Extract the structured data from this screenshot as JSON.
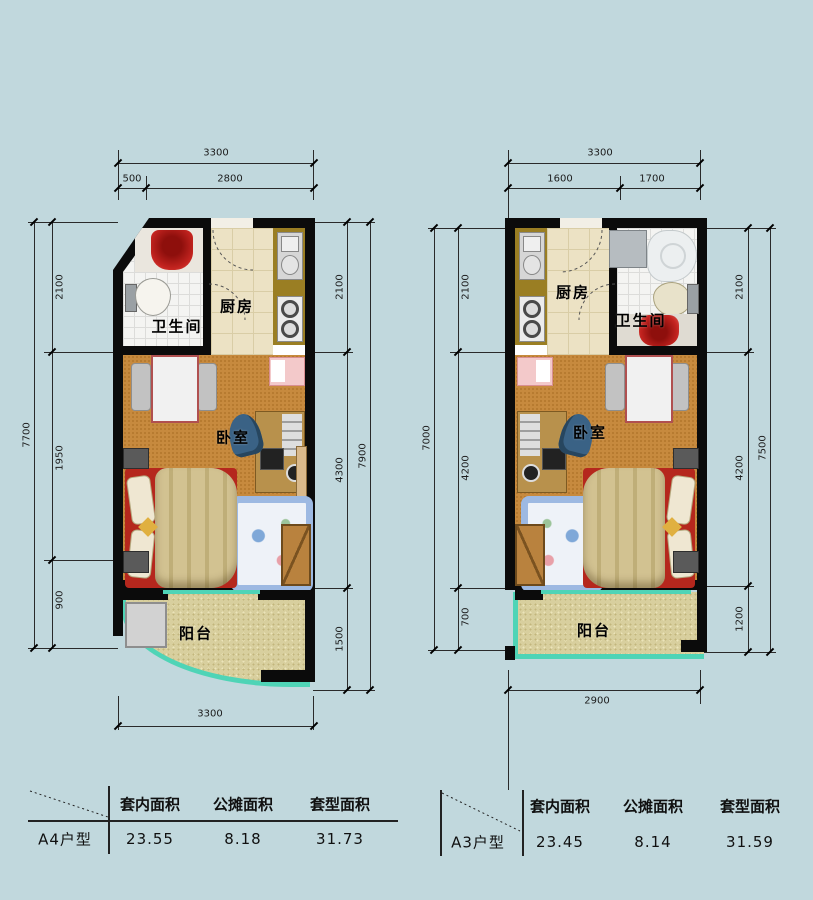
{
  "colors": {
    "background": "#c1d8dd",
    "wall": "#0b0b0b",
    "balcony_trim": "#4fd4b6",
    "bedroom_floor": "#c78a3e",
    "kitchen_counter": "#9a7e23",
    "bed_red": "#b5271d"
  },
  "plans": [
    {
      "name": "A4",
      "rooms": {
        "bathroom": "卫生间",
        "kitchen": "厨房",
        "bedroom": "卧室",
        "balcony": "阳台"
      },
      "dims": {
        "top_total": "3300",
        "top_seg1": "500",
        "top_seg2": "2800",
        "bottom_total": "3300",
        "left_total": "7700",
        "left_seg1": "2100",
        "left_seg2": "1950",
        "left_seg3": "900",
        "right_total": "7900",
        "right_seg1": "2100",
        "right_seg2": "4300",
        "right_seg3": "1500"
      },
      "table": {
        "label": "A4户型",
        "col1": "套内面积",
        "col2": "公摊面积",
        "col3": "套型面积",
        "val1": "23.55",
        "val2": "8.18",
        "val3": "31.73"
      }
    },
    {
      "name": "A3",
      "rooms": {
        "bathroom": "卫生间",
        "kitchen": "厨房",
        "bedroom": "卧室",
        "balcony": "阳台"
      },
      "dims": {
        "top_total": "3300",
        "top_seg1": "1600",
        "top_seg2": "1700",
        "bottom_total": "2900",
        "left_total": "7000",
        "left_seg1": "2100",
        "left_seg2": "4200",
        "left_seg3": "700",
        "right_total": "7500",
        "right_seg1": "2100",
        "right_seg2": "4200",
        "right_seg3": "1200"
      },
      "table": {
        "label": "A3户型",
        "col1": "套内面积",
        "col2": "公摊面积",
        "col3": "套型面积",
        "val1": "23.45",
        "val2": "8.14",
        "val3": "31.59"
      }
    }
  ]
}
